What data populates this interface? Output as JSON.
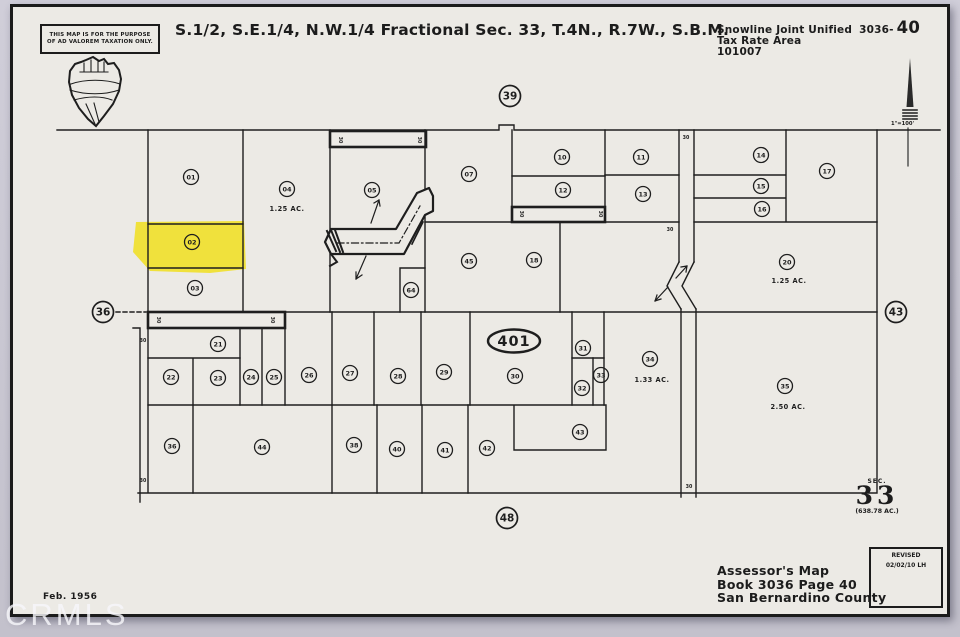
{
  "page": {
    "watermark": "CRMLS"
  },
  "header": {
    "stamp": [
      "THIS MAP IS FOR THE PURPOSE",
      "OF AD VALOREM TAXATION ONLY."
    ],
    "title": "S.1/2, S.E.1/4, N.W.1/4 Fractional Sec. 33, T.4N., R.7W., S.B.M.",
    "district": "Snowline Joint Unified",
    "book_dash": "3036-",
    "page_number": "40",
    "tax_rate_area_label": "Tax Rate Area",
    "tax_rate_area_code": "101007",
    "scale_label": "1\"=100'"
  },
  "section_marker": {
    "sec_label": "SEC.",
    "sec_number": "33",
    "sec_acreage": "(638.78 AC.)"
  },
  "footer": {
    "date": "Feb. 1956",
    "map_line1": "Assessor's Map",
    "map_line2": "Book 3036 Page 40",
    "map_line3": "San Bernardino County",
    "revised_label": "REVISED",
    "revised_value": "02/02/10 LH"
  },
  "map": {
    "boundary_circles": [
      {
        "label": "39",
        "x": 510,
        "y": 96
      },
      {
        "label": "36",
        "x": 103,
        "y": 312
      },
      {
        "label": "43",
        "x": 896,
        "y": 312
      },
      {
        "label": "48",
        "x": 507,
        "y": 518
      }
    ],
    "highway_shield": {
      "route": "401",
      "x": 514,
      "y": 341
    },
    "parcels": [
      {
        "num": "01",
        "x": 191,
        "y": 177
      },
      {
        "num": "02",
        "x": 192,
        "y": 242,
        "highlighted": true
      },
      {
        "num": "03",
        "x": 195,
        "y": 288
      },
      {
        "num": "04",
        "x": 287,
        "y": 189
      },
      {
        "num": "05",
        "x": 372,
        "y": 190
      },
      {
        "num": "07",
        "x": 469,
        "y": 174
      },
      {
        "num": "10",
        "x": 562,
        "y": 157
      },
      {
        "num": "11",
        "x": 641,
        "y": 157
      },
      {
        "num": "12",
        "x": 563,
        "y": 190
      },
      {
        "num": "13",
        "x": 643,
        "y": 194
      },
      {
        "num": "14",
        "x": 761,
        "y": 155
      },
      {
        "num": "15",
        "x": 761,
        "y": 186
      },
      {
        "num": "16",
        "x": 762,
        "y": 209
      },
      {
        "num": "17",
        "x": 827,
        "y": 171
      },
      {
        "num": "18",
        "x": 534,
        "y": 260
      },
      {
        "num": "20",
        "x": 787,
        "y": 262
      },
      {
        "num": "21",
        "x": 218,
        "y": 344
      },
      {
        "num": "22",
        "x": 171,
        "y": 377
      },
      {
        "num": "23",
        "x": 218,
        "y": 378
      },
      {
        "num": "24",
        "x": 251,
        "y": 377
      },
      {
        "num": "25",
        "x": 274,
        "y": 377
      },
      {
        "num": "26",
        "x": 309,
        "y": 375
      },
      {
        "num": "27",
        "x": 350,
        "y": 373
      },
      {
        "num": "28",
        "x": 398,
        "y": 376
      },
      {
        "num": "29",
        "x": 444,
        "y": 372
      },
      {
        "num": "30",
        "x": 515,
        "y": 376
      },
      {
        "num": "31",
        "x": 583,
        "y": 348
      },
      {
        "num": "32",
        "x": 582,
        "y": 388
      },
      {
        "num": "33",
        "x": 601,
        "y": 375
      },
      {
        "num": "34",
        "x": 650,
        "y": 359
      },
      {
        "num": "35",
        "x": 785,
        "y": 386
      },
      {
        "num": "36",
        "x": 172,
        "y": 446
      },
      {
        "num": "38",
        "x": 354,
        "y": 445
      },
      {
        "num": "40",
        "x": 397,
        "y": 449
      },
      {
        "num": "41",
        "x": 445,
        "y": 450
      },
      {
        "num": "42",
        "x": 487,
        "y": 448
      },
      {
        "num": "43",
        "x": 580,
        "y": 432
      },
      {
        "num": "44",
        "x": 262,
        "y": 447
      },
      {
        "num": "45",
        "x": 469,
        "y": 261
      },
      {
        "num": "64",
        "x": 411,
        "y": 290
      }
    ],
    "acreage_labels": [
      {
        "text": "1.25 AC.",
        "x": 287,
        "y": 211
      },
      {
        "text": "1.25 AC.",
        "x": 789,
        "y": 283
      },
      {
        "text": "1.33 AC.",
        "x": 652,
        "y": 382
      },
      {
        "text": "2.50 AC.",
        "x": 788,
        "y": 409
      }
    ],
    "road_width_labels": [
      {
        "text": "30",
        "x": 686,
        "y": 139,
        "rot": 0
      },
      {
        "text": "30",
        "x": 670,
        "y": 231,
        "rot": 0
      },
      {
        "text": "30",
        "x": 689,
        "y": 488,
        "rot": 0
      },
      {
        "text": "30",
        "x": 143,
        "y": 342,
        "rot": 0
      },
      {
        "text": "30",
        "x": 143,
        "y": 482,
        "rot": 0
      },
      {
        "text": "30",
        "x": 339,
        "y": 140,
        "rot": 90
      },
      {
        "text": "30",
        "x": 418,
        "y": 140,
        "rot": 90
      },
      {
        "text": "30",
        "x": 520,
        "y": 214,
        "rot": 90
      },
      {
        "text": "30",
        "x": 599,
        "y": 214,
        "rot": 90
      },
      {
        "text": "30",
        "x": 157,
        "y": 320,
        "rot": 90
      },
      {
        "text": "30",
        "x": 271,
        "y": 320,
        "rot": 90
      }
    ]
  },
  "colors": {
    "highlight": "#f0e13c",
    "sheet": "#eceae5",
    "page_bg": "#c9c7d2",
    "ink": "#1e1e1e"
  }
}
